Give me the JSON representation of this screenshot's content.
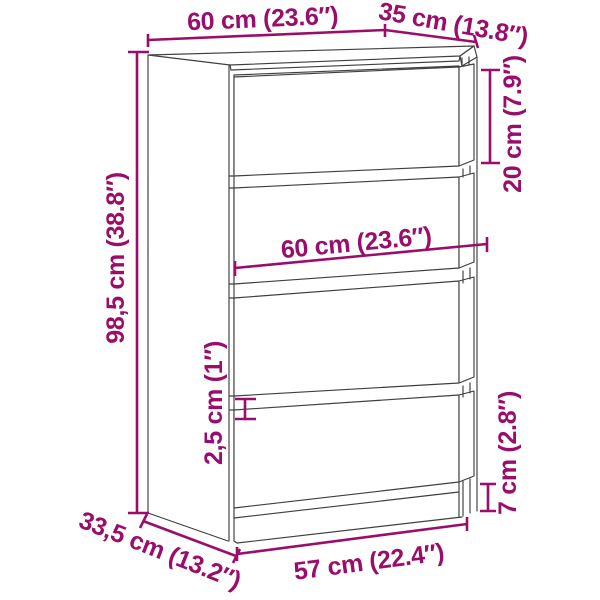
{
  "diagram": {
    "subject": "chest-of-drawers-4-drawer-line-drawing",
    "background_color": "#ffffff",
    "outline_color": "#3f3f3f",
    "accent_color": "#9a0e6b",
    "measurements": {
      "overall_width": "60 cm (23.6″)",
      "overall_depth": "35 cm (13.8″)",
      "overall_height": "98,5 cm (38.8″)",
      "top_drawer_height": "20 cm (7.9″)",
      "drawer_front_width": "60 cm (23.6″)",
      "drawer_gap": "2,5 cm (1″)",
      "plinth_height": "7 cm (2.8″)",
      "base_width": "57 cm (22.4″)",
      "base_depth": "33,5 cm (13.2″)"
    }
  }
}
